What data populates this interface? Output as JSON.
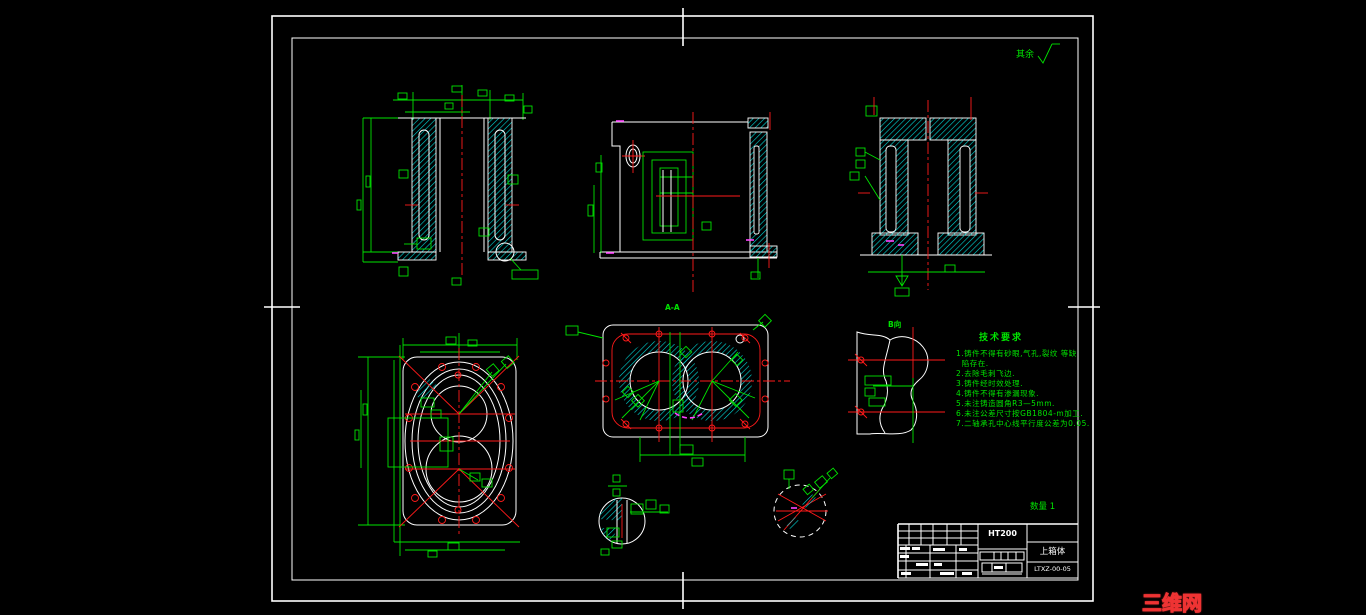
{
  "colors": {
    "line_green": "#00e400",
    "hatch_cyan": "#00d8d8",
    "center_red": "#ff1a1a",
    "detail_magenta": "#ff44ff",
    "line_white": "#ffffff",
    "watermark_red": "#ee3333"
  },
  "surface_note": {
    "label": "其余"
  },
  "tech_requirements": {
    "title": "技术要求",
    "lines": [
      "1.铸件不得有砂眼,气孔,裂纹 等缺",
      "  陷存在.",
      "2.去除毛刺飞边.",
      "3.铸件经时效处理.",
      "4.铸件不得有渗漏现象.",
      "5.未注铸造圆角R3—5mm.",
      "6.未注公差尺寸按GB1804-m加工.",
      "7.二轴承孔中心线平行度公差为0.05."
    ]
  },
  "view_labels": {
    "section_label": "A-A",
    "aux_view_label": "B向"
  },
  "title_block": {
    "material": "HT200",
    "part_name": "上箱体",
    "drawing_no": "LTXZ-00-05",
    "quantity_note": "数量 1"
  },
  "watermark": {
    "text": "三维网www.3dportal.cn"
  }
}
